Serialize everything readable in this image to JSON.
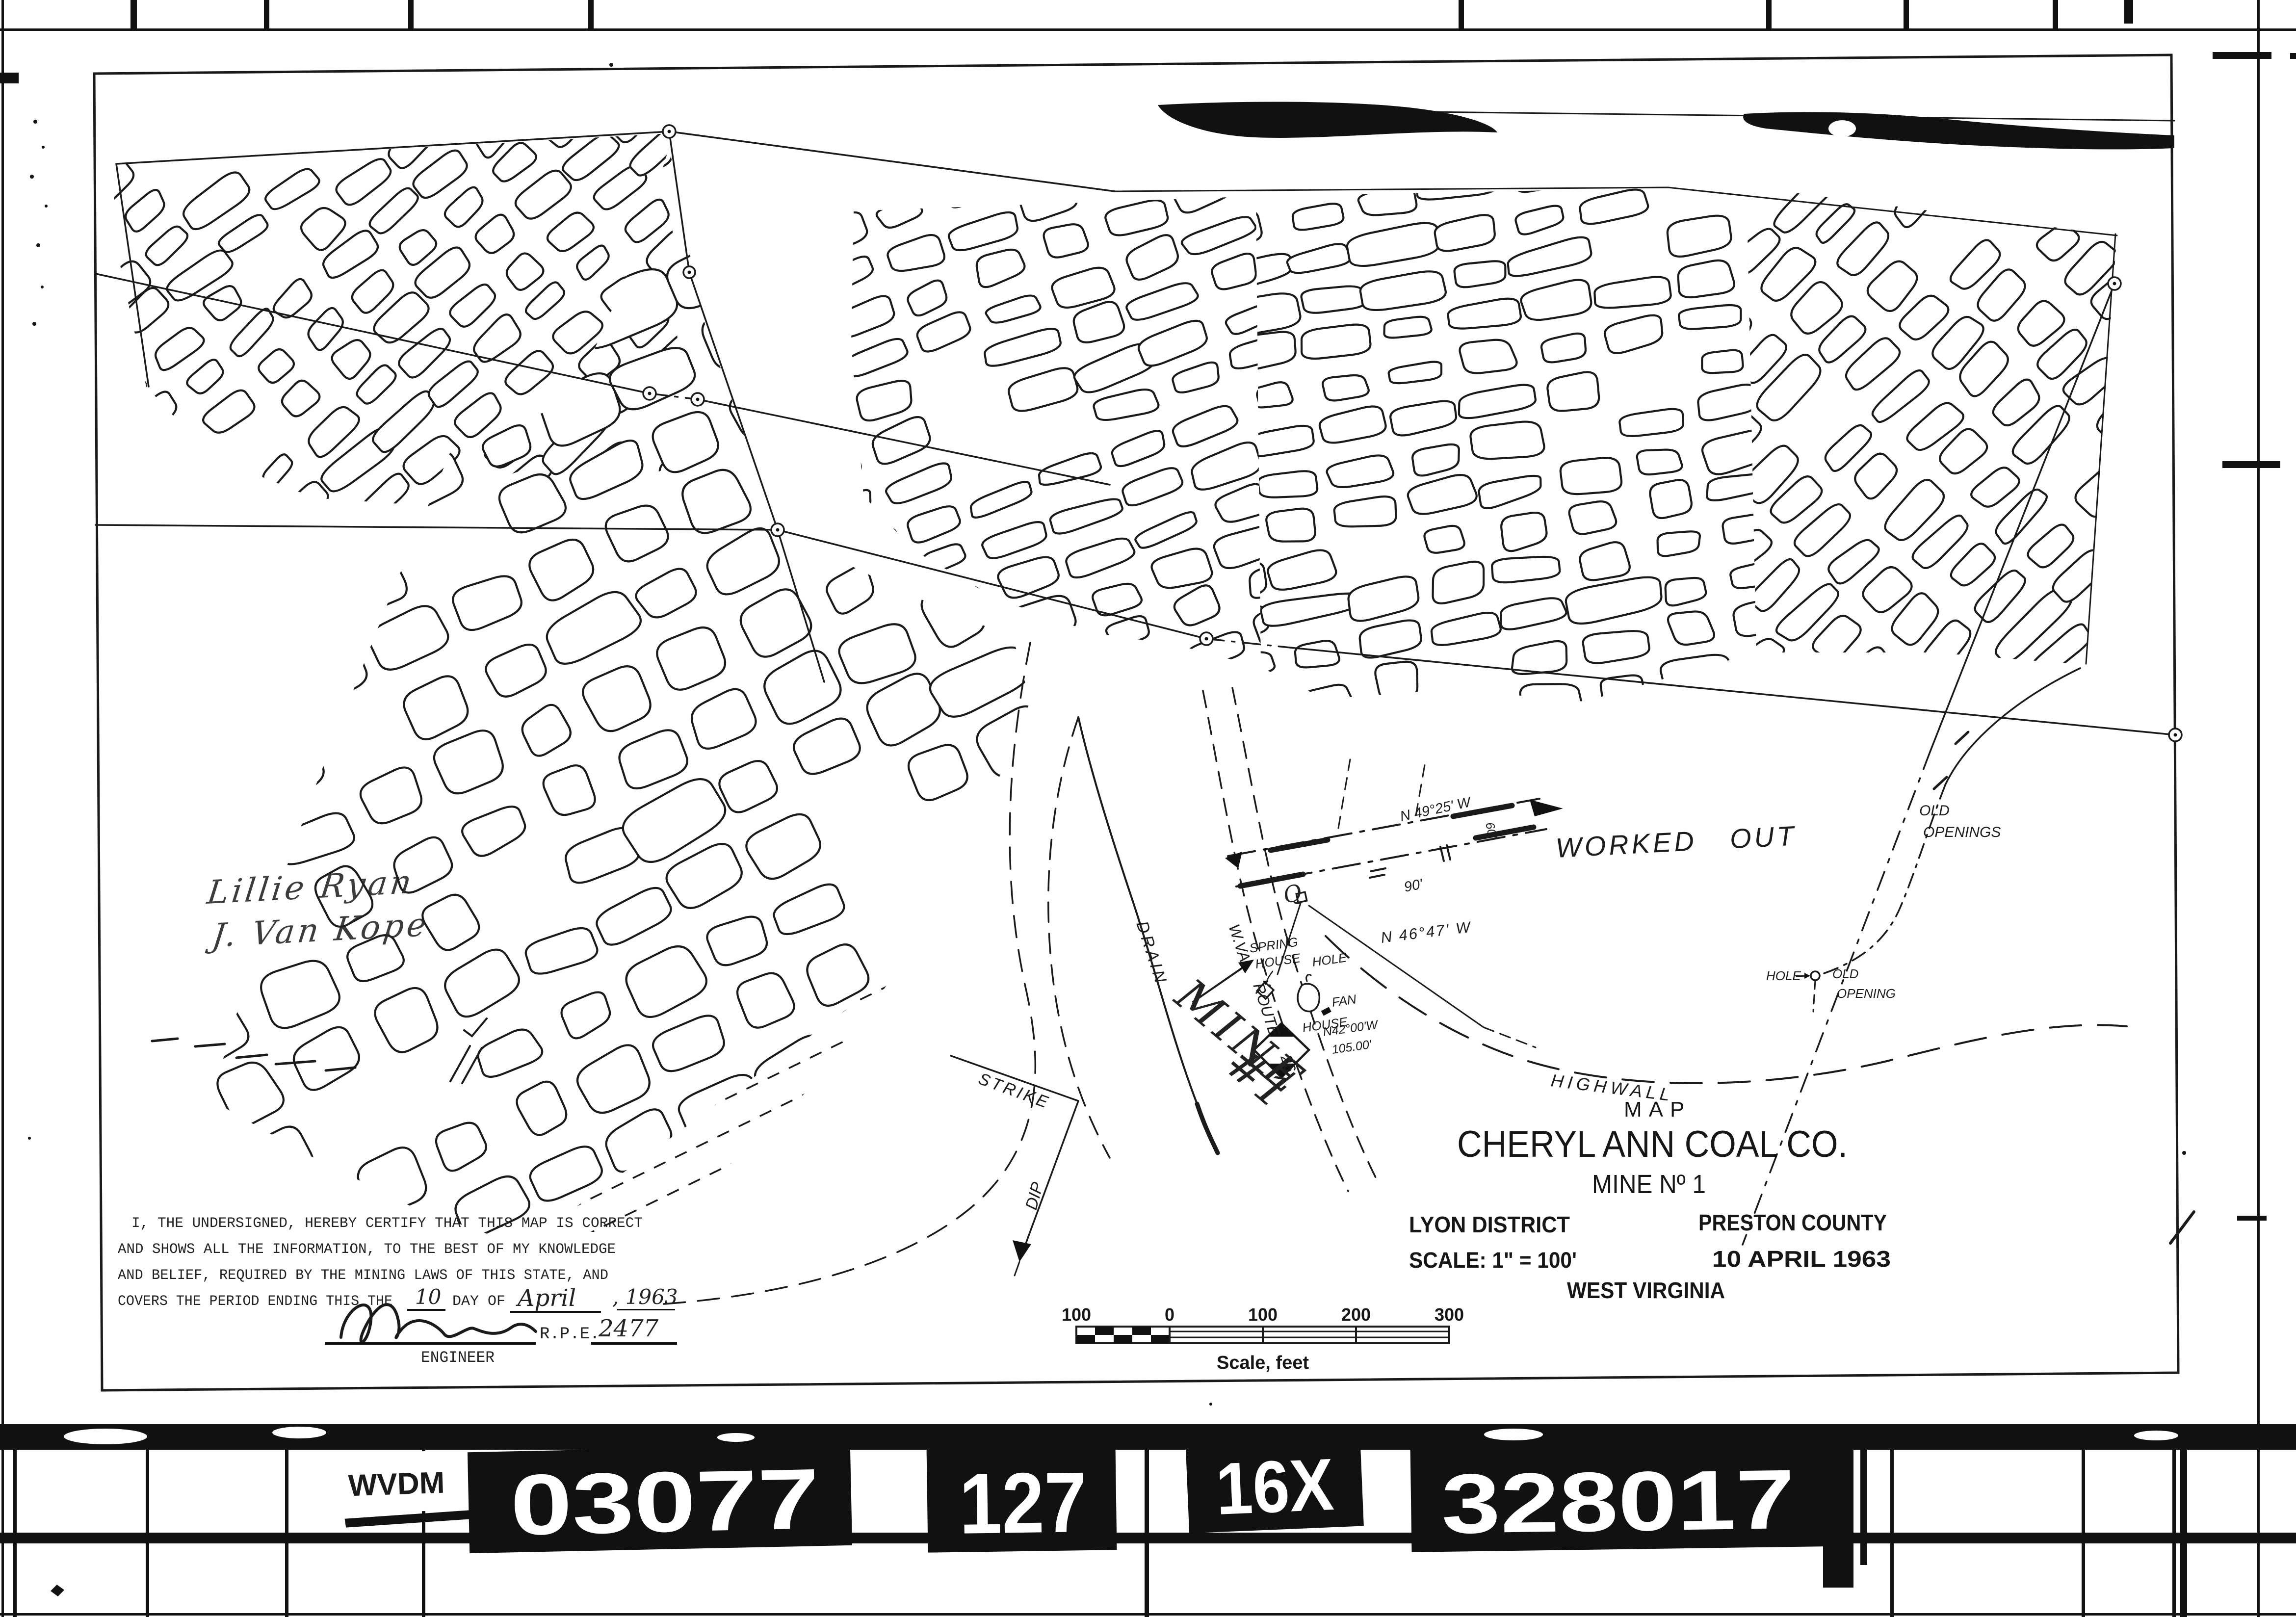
{
  "colors": {
    "ink": "#1a1a1a",
    "paper": "#ffffff"
  },
  "title_block": {
    "map": "MAP",
    "company": "CHERYL ANN COAL CO.",
    "mine": "MINE Nº 1",
    "district": "LYON DISTRICT",
    "county": "PRESTON COUNTY",
    "scale": "SCALE: 1\" = 100'",
    "date": "10 APRIL 1963",
    "state": "WEST VIRGINIA"
  },
  "certification": {
    "line1": "I, THE UNDERSIGNED, HEREBY CERTIFY THAT THIS MAP IS CORRECT",
    "line2": "AND SHOWS ALL THE INFORMATION, TO THE BEST OF MY KNOWLEDGE",
    "line3": "AND BELIEF, REQUIRED BY THE MINING LAWS OF THIS STATE, AND",
    "line4": "COVERS THE PERIOD ENDING THIS THE",
    "day": "10",
    "day_of": "DAY OF",
    "month": "April",
    "year": ", 1963",
    "rpe": "R.P.E.",
    "license": "2477",
    "role": "ENGINEER"
  },
  "scale_bar": {
    "labels": [
      "100",
      "0",
      "100",
      "200",
      "300"
    ],
    "caption": "Scale, feet"
  },
  "map_labels": {
    "worked_out": "WORKED OUT",
    "highwall": "HIGHWALL",
    "old1": "OLD",
    "openings": "OPENINGS",
    "old2": "OLD",
    "opening": "OPENING",
    "hole1": "HOLE",
    "hole2": "HOLE",
    "house": "HOUSE",
    "spring1": "SPRING",
    "spring2": "HOUSE",
    "fan": "FAN",
    "drain": "DRAIN",
    "mine_name": "MINE",
    "mine_number": "#1",
    "wva": "W.VA.",
    "route": "ROUTE",
    "route_number": "26",
    "strike": "STRIKE",
    "dip": "DIP",
    "bearing_top": "N 49°25' W",
    "width_90": "90'",
    "bearing_mid": "N 46°47' W",
    "bearing_low": "N42°00'W",
    "distance_low": "105.00'",
    "width_60": "60'",
    "q_mark": "Q"
  },
  "annotations": {
    "hand_line1": "Lillie Ryan",
    "hand_line2": "J. Van Kope"
  },
  "film_strip": {
    "agency": "WVDM",
    "reel": "03077",
    "frame": "127",
    "reduction": "16X",
    "item": "328017"
  }
}
